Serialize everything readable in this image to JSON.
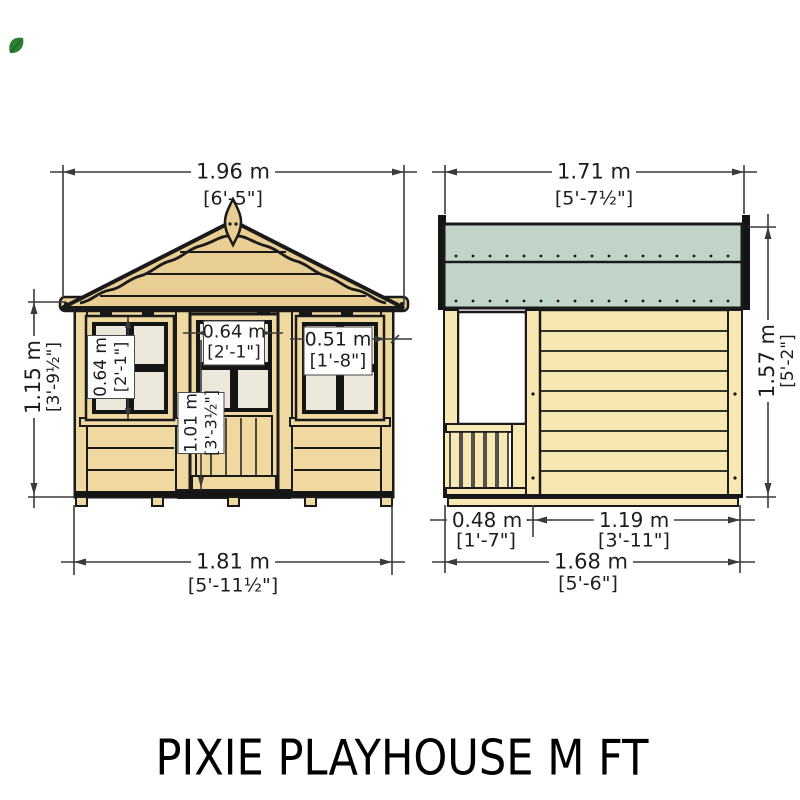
{
  "title": "PIXIE PLAYHOUSE M FT",
  "logo": {
    "name": "green-brand-mark",
    "color": "#2e7d32"
  },
  "front_view": {
    "label": "front-elevation",
    "width_top": {
      "metric": "1.96 m",
      "imperial": "[6'-5\"]"
    },
    "height_left": {
      "metric": "1.15 m",
      "imperial": "[3'-9½\"]"
    },
    "window_left": {
      "metric": "0.64 m",
      "imperial": "[2'-1\"]"
    },
    "door_window": {
      "metric": "0.64 m",
      "imperial": "[2'-1\"]"
    },
    "window_right": {
      "metric": "0.51 m",
      "imperial": "[1'-8\"]"
    },
    "door_height": {
      "metric": "1.01 m",
      "imperial": "[3'-3½\"]"
    },
    "width_bottom": {
      "metric": "1.81 m",
      "imperial": "[5'-11½\"]"
    }
  },
  "side_view": {
    "label": "side-elevation",
    "width_top": {
      "metric": "1.71 m",
      "imperial": "[5'-7½\"]"
    },
    "height_right": {
      "metric": "1.57 m",
      "imperial": "[5'-2\"]"
    },
    "porch_depth": {
      "metric": "0.48 m",
      "imperial": "[1'-7\"]"
    },
    "wall_length": {
      "metric": "1.19 m",
      "imperial": "[3'-11\"]"
    },
    "width_bottom": {
      "metric": "1.68 m",
      "imperial": "[5'-6\"]"
    }
  },
  "colors": {
    "roof_wood": "#e8ce92",
    "wall_wood": "#f0d9a0",
    "side_wall_wood": "#f7e8b3",
    "window_pane": "#ece7db",
    "roof_felt_green": "#c0d5c8",
    "outline": "#1a1a1a"
  }
}
